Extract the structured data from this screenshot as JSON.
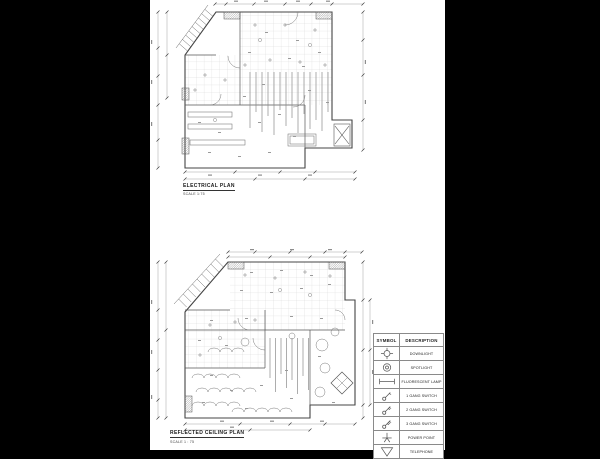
{
  "document": {
    "background_color": "#000000",
    "sheet_color": "#ffffff",
    "line_color": "#555555"
  },
  "plans": {
    "electrical": {
      "title": "ELECTRICAL PLAN",
      "scale": "SCALE 1:75"
    },
    "reflected_ceiling": {
      "title": "REFLECTED CEILING PLAN",
      "scale": "SCALE 1 : 75"
    }
  },
  "legend": {
    "headers": [
      "SYMBOL",
      "DESCRIPTION"
    ],
    "rows": [
      {
        "symbol": "downlight-icon",
        "description": "DOWNLIGHT"
      },
      {
        "symbol": "spotlight-icon",
        "description": "SPOTLIGHT"
      },
      {
        "symbol": "fluorescent-lamp-icon",
        "description": "FLUORESCENT LAMP"
      },
      {
        "symbol": "one-gang-switch-icon",
        "description": "1 GANG SWITCH"
      },
      {
        "symbol": "two-gang-switch-icon",
        "description": "2 GANG SWITCH"
      },
      {
        "symbol": "three-gang-switch-icon",
        "description": "3 GANG SWITCH"
      },
      {
        "symbol": "power-point-icon",
        "description": "POWER POINT"
      },
      {
        "symbol": "telephone-icon",
        "description": "TELEPHONE"
      }
    ]
  }
}
